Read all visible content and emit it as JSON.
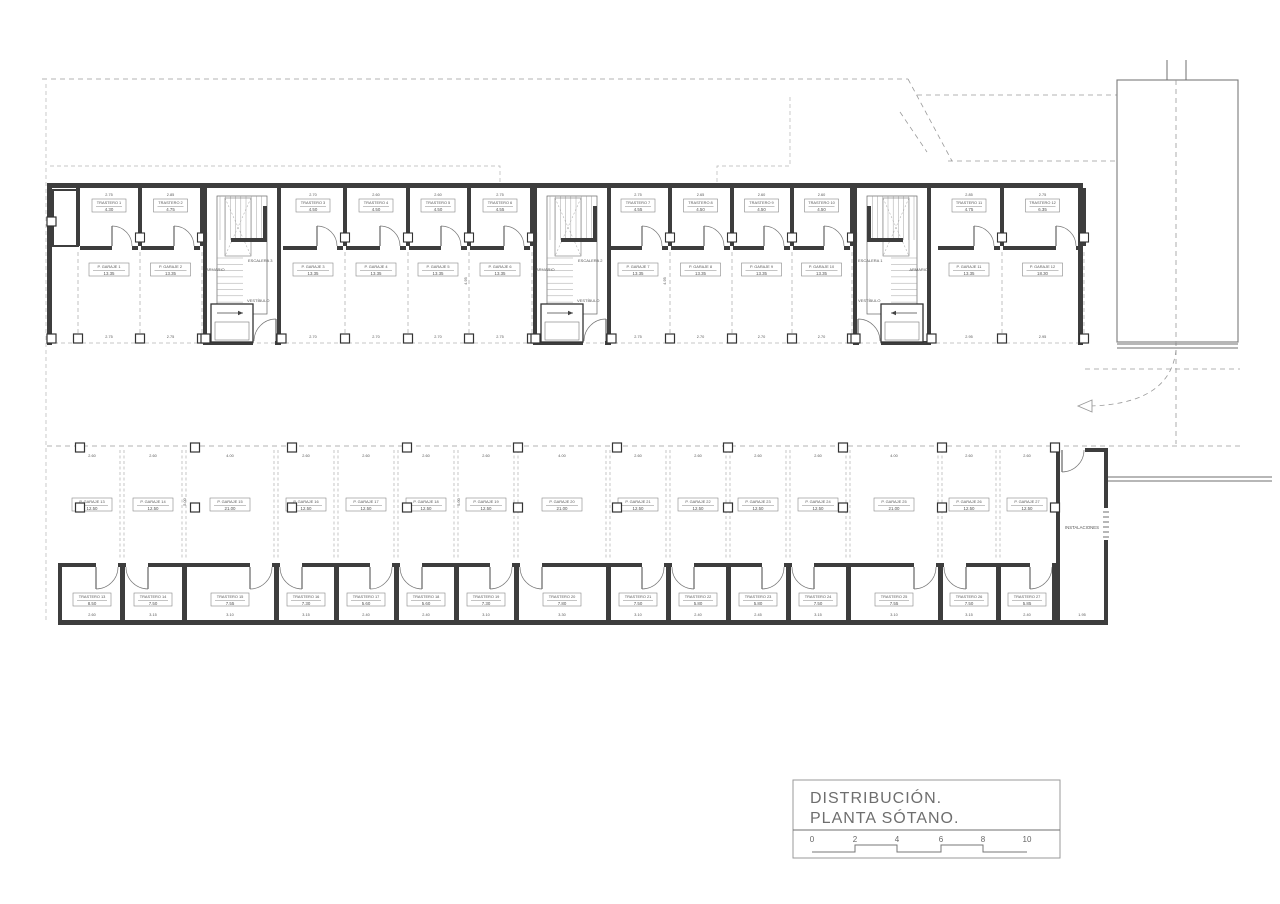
{
  "drawing": {
    "upper_units": [
      {
        "trastero": "TRASTERO 1",
        "trastero_area": "4.30",
        "garaje": "P. GARAJE 1",
        "garaje_area": "13.35",
        "dim_top": "2.75",
        "dim_bottom": "2.75"
      },
      {
        "trastero": "TRASTERO 2",
        "trastero_area": "4.75",
        "garaje": "P. GARAJE 2",
        "garaje_area": "13.35",
        "dim_top": "2.85",
        "dim_bottom": "2.75"
      },
      {
        "trastero": "TRASTERO 3",
        "trastero_area": "4.50",
        "garaje": "P. GARAJE 3",
        "garaje_area": "13.35",
        "dim_top": "2.70",
        "dim_bottom": "2.70"
      },
      {
        "trastero": "TRASTERO 4",
        "trastero_area": "4.50",
        "garaje": "P. GARAJE 4",
        "garaje_area": "13.35",
        "dim_top": "2.60",
        "dim_bottom": "2.70"
      },
      {
        "trastero": "TRASTERO 5",
        "trastero_area": "4.50",
        "garaje": "P. GARAJE 5",
        "garaje_area": "13.35",
        "dim_top": "2.60",
        "dim_bottom": "2.70"
      },
      {
        "trastero": "TRASTERO 6",
        "trastero_area": "4.55",
        "garaje": "P. GARAJE 6",
        "garaje_area": "13.35",
        "dim_top": "2.75",
        "dim_bottom": "2.75"
      },
      {
        "trastero": "TRASTERO 7",
        "trastero_area": "4.55",
        "garaje": "P. GARAJE 7",
        "garaje_area": "13.35",
        "dim_top": "2.75",
        "dim_bottom": "2.75"
      },
      {
        "trastero": "TRASTERO 8",
        "trastero_area": "4.50",
        "garaje": "P. GARAJE 8",
        "garaje_area": "13.35",
        "dim_top": "2.65",
        "dim_bottom": "2.70"
      },
      {
        "trastero": "TRASTERO 9",
        "trastero_area": "4.50",
        "garaje": "P. GARAJE 9",
        "garaje_area": "13.35",
        "dim_top": "2.60",
        "dim_bottom": "2.70"
      },
      {
        "trastero": "TRASTERO 10",
        "trastero_area": "4.50",
        "garaje": "P. GARAJE 10",
        "garaje_area": "13.35",
        "dim_top": "2.60",
        "dim_bottom": "2.70"
      },
      {
        "trastero": "TRASTERO 11",
        "trastero_area": "4.75",
        "garaje": "P. GARAJE 11",
        "garaje_area": "13.35",
        "dim_top": "2.85",
        "dim_bottom": "2.95"
      },
      {
        "trastero": "TRASTERO 12",
        "trastero_area": "6.35",
        "garaje": "P. GARAJE 12",
        "garaje_area": "18.30",
        "dim_top": "2.75",
        "dim_bottom": "2.95"
      }
    ],
    "stair_cores": [
      {
        "escalera": "ESCALERA 3",
        "armario": "ARMARIO",
        "vestibulo": "VESTÍBULO"
      },
      {
        "escalera": "ESCALERA 2",
        "armario": "ARMARIO",
        "vestibulo": "VESTÍBULO"
      },
      {
        "escalera": "ESCALERA 1",
        "armario": "ARMARIO",
        "vestibulo": "VESTÍBULO"
      }
    ],
    "lower_garages": [
      {
        "label": "P. GARAJE 13",
        "area": "12.50",
        "dim": "2.60"
      },
      {
        "label": "P. GARAJE 14",
        "area": "12.50",
        "dim": "2.60"
      },
      {
        "label": "P. GARAJE 15",
        "area": "21.00",
        "dim": "4.00"
      },
      {
        "label": "P. GARAJE 16",
        "area": "12.50",
        "dim": "2.60"
      },
      {
        "label": "P. GARAJE 17",
        "area": "12.50",
        "dim": "2.60"
      },
      {
        "label": "P. GARAJE 18",
        "area": "12.50",
        "dim": "2.60"
      },
      {
        "label": "P. GARAJE 19",
        "area": "12.50",
        "dim": "2.60"
      },
      {
        "label": "P. GARAJE 20",
        "area": "21.00",
        "dim": "4.00"
      },
      {
        "label": "P. GARAJE 21",
        "area": "12.50",
        "dim": "2.60"
      },
      {
        "label": "P. GARAJE 22",
        "area": "12.50",
        "dim": "2.60"
      },
      {
        "label": "P. GARAJE 23",
        "area": "12.50",
        "dim": "2.60"
      },
      {
        "label": "P. GARAJE 24",
        "area": "12.50",
        "dim": "2.60"
      },
      {
        "label": "P. GARAJE 25",
        "area": "21.00",
        "dim": "4.00"
      },
      {
        "label": "P. GARAJE 26",
        "area": "12.50",
        "dim": "2.60"
      },
      {
        "label": "P. GARAJE 27",
        "area": "12.50",
        "dim": "2.60"
      }
    ],
    "lower_trasteros": [
      {
        "label": "TRASTERO 13",
        "area": "8.50",
        "dim": "2.60"
      },
      {
        "label": "TRASTERO 14",
        "area": "7.50",
        "dim": "3.15"
      },
      {
        "label": "TRASTERO 15",
        "area": "7.55",
        "dim": "3.10"
      },
      {
        "label": "TRASTERO 16",
        "area": "7.30",
        "dim": "3.15"
      },
      {
        "label": "TRASTERO 17",
        "area": "5.60",
        "dim": "2.40"
      },
      {
        "label": "TRASTERO 18",
        "area": "5.60",
        "dim": "2.40"
      },
      {
        "label": "TRASTERO 19",
        "area": "7.30",
        "dim": "3.10"
      },
      {
        "label": "TRASTERO 20",
        "area": "7.80",
        "dim": "3.30"
      },
      {
        "label": "TRASTERO 21",
        "area": "7.50",
        "dim": "3.10"
      },
      {
        "label": "TRASTERO 22",
        "area": "5.80",
        "dim": "2.40"
      },
      {
        "label": "TRASTERO 23",
        "area": "5.80",
        "dim": "2.45"
      },
      {
        "label": "TRASTERO 24",
        "area": "7.50",
        "dim": "3.15"
      },
      {
        "label": "TRASTERO 25",
        "area": "7.55",
        "dim": "3.10"
      },
      {
        "label": "TRASTERO 26",
        "area": "7.50",
        "dim": "3.15"
      },
      {
        "label": "TRASTERO 27",
        "area": "5.85",
        "dim": "2.40"
      }
    ],
    "instalaciones_label": "INSTALACIONES",
    "instalaciones_dim": "1.95",
    "depth_dims": {
      "upper": "4.95",
      "lower": "5.00"
    }
  },
  "title_block": {
    "line1": "DISTRIBUCIÓN.",
    "line2": "PLANTA SÓTANO.",
    "scale_marks": [
      "0",
      "2",
      "4",
      "6",
      "8",
      "10"
    ]
  }
}
